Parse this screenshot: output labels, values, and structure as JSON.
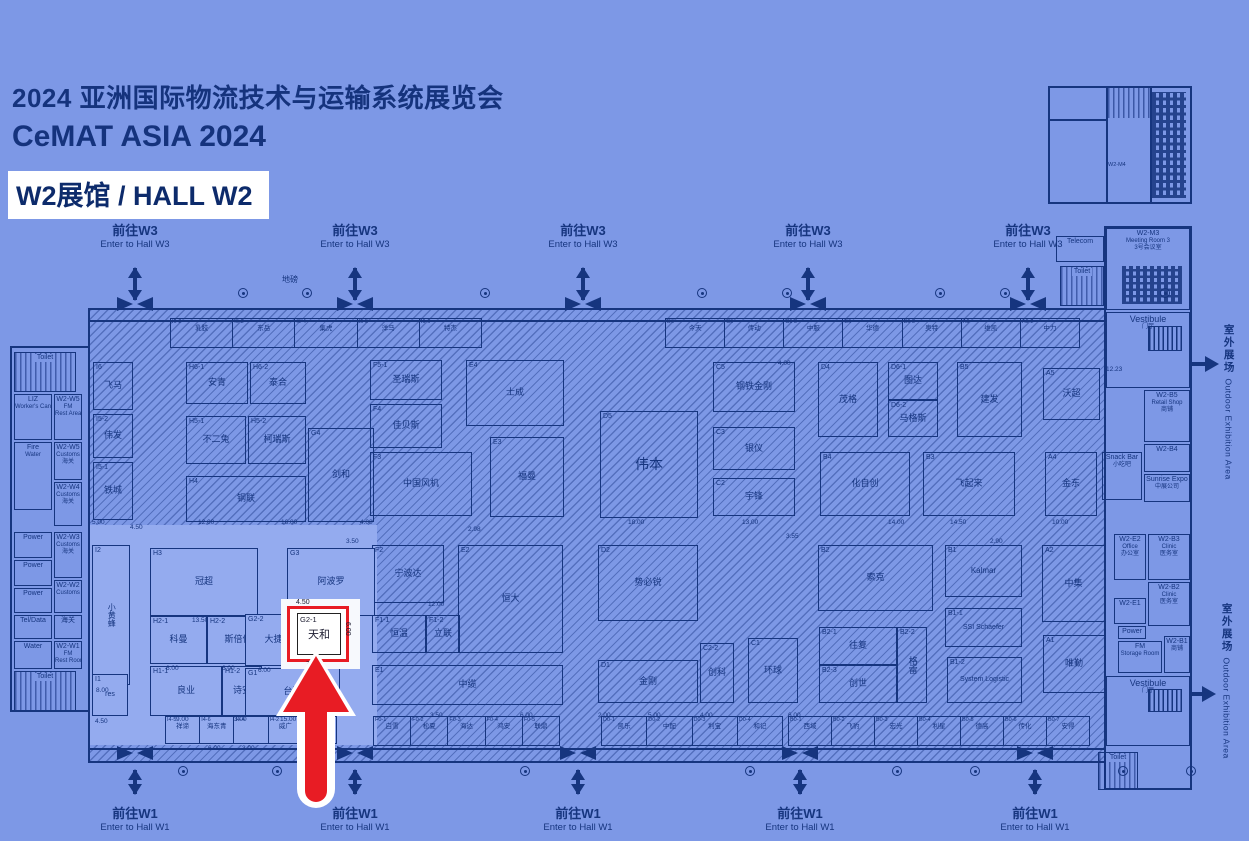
{
  "header": {
    "title_line1": "2024 亚洲国际物流技术与运输系统展览会",
    "title_line2": "CeMAT ASIA 2024",
    "hall_badge": "W2展馆 / HALL W2"
  },
  "nav": {
    "to_w3_cn": "前往W3",
    "to_w3_en": "Enter to Hall W3",
    "to_w1_cn": "前往W1",
    "to_w1_en": "Enter to Hall W1",
    "top_positions": [
      135,
      355,
      583,
      808,
      1028
    ],
    "bottom_positions": [
      135,
      355,
      578,
      800,
      1035
    ]
  },
  "outdoor": {
    "cn": "室外展场",
    "en": "Outdoor Exhibition Area"
  },
  "labels": {
    "weighbridge": "地磅",
    "mini_building": "W2-M4"
  },
  "highlight": {
    "id": "G2-1",
    "name": "天和",
    "dim_top": "4.50",
    "dim_bottom": "7.00",
    "dim_right": "6.00"
  },
  "colors": {
    "background": "#7d98e6",
    "line_navy": "#16357f",
    "light_zone": "#94abef",
    "highlight_red": "#e81c24",
    "badge_bg": "#ffffff"
  },
  "left_wing": {
    "rooms": [
      {
        "x": 14,
        "y": 352,
        "w": 62,
        "h": 40,
        "lines": [
          "Toilet"
        ],
        "hatch": 1
      },
      {
        "x": 14,
        "y": 394,
        "w": 38,
        "h": 46,
        "lines": [
          "LIZ",
          "Worker's Canteen"
        ]
      },
      {
        "x": 54,
        "y": 394,
        "w": 28,
        "h": 46,
        "lines": [
          "W2-W5",
          "FM",
          "Rest Area"
        ]
      },
      {
        "x": 14,
        "y": 442,
        "w": 38,
        "h": 68,
        "lines": [
          "Fire",
          "Water"
        ]
      },
      {
        "x": 54,
        "y": 442,
        "w": 28,
        "h": 38,
        "lines": [
          "W2-W5",
          "Customs",
          "海关"
        ]
      },
      {
        "x": 54,
        "y": 482,
        "w": 28,
        "h": 44,
        "lines": [
          "W2-W4",
          "Customs",
          "海关"
        ]
      },
      {
        "x": 14,
        "y": 532,
        "w": 38,
        "h": 26,
        "lines": [
          "Power"
        ]
      },
      {
        "x": 54,
        "y": 532,
        "w": 28,
        "h": 46,
        "lines": [
          "W2-W3",
          "Customs",
          "海关"
        ]
      },
      {
        "x": 14,
        "y": 560,
        "w": 38,
        "h": 26,
        "lines": [
          "Power"
        ]
      },
      {
        "x": 14,
        "y": 588,
        "w": 38,
        "h": 25,
        "lines": [
          "Power"
        ]
      },
      {
        "x": 54,
        "y": 580,
        "w": 28,
        "h": 33,
        "lines": [
          "W2-W2",
          "Customs"
        ]
      },
      {
        "x": 14,
        "y": 615,
        "w": 38,
        "h": 24,
        "lines": [
          "Tel/Data"
        ]
      },
      {
        "x": 54,
        "y": 615,
        "w": 28,
        "h": 24,
        "lines": [
          "海关"
        ]
      },
      {
        "x": 14,
        "y": 641,
        "w": 38,
        "h": 28,
        "lines": [
          "Water"
        ]
      },
      {
        "x": 54,
        "y": 641,
        "w": 28,
        "h": 28,
        "lines": [
          "W2-W1",
          "FM",
          "Rest Room"
        ]
      },
      {
        "x": 14,
        "y": 671,
        "w": 62,
        "h": 40,
        "lines": [
          "Toilet"
        ],
        "hatch": 1
      }
    ]
  },
  "right_wing": {
    "rooms": [
      {
        "x": 1056,
        "y": 236,
        "w": 48,
        "h": 26,
        "lines": [
          "Telecom"
        ]
      },
      {
        "x": 1060,
        "y": 266,
        "w": 44,
        "h": 40,
        "lines": [
          "Toilet"
        ],
        "hatch": 1
      },
      {
        "x": 1106,
        "y": 228,
        "w": 84,
        "h": 82,
        "lines": [
          "W2-M3",
          "Meeting Room 3",
          "3号会议室"
        ],
        "seats": 1
      },
      {
        "x": 1106,
        "y": 312,
        "w": 84,
        "h": 76,
        "lines": [
          "Vestibule",
          "门厅"
        ],
        "stairs": 1,
        "big": 1
      },
      {
        "x": 1144,
        "y": 390,
        "w": 46,
        "h": 52,
        "lines": [
          "W2-B5",
          "Retail Shop",
          "商铺"
        ]
      },
      {
        "x": 1144,
        "y": 444,
        "w": 46,
        "h": 28,
        "lines": [
          "W2-B4"
        ]
      },
      {
        "x": 1102,
        "y": 452,
        "w": 40,
        "h": 48,
        "lines": [
          "Snack Bar",
          "小吃吧"
        ]
      },
      {
        "x": 1144,
        "y": 474,
        "w": 46,
        "h": 28,
        "lines": [
          "Sunrise Expo",
          "中展公司"
        ]
      },
      {
        "x": 1114,
        "y": 534,
        "w": 32,
        "h": 46,
        "lines": [
          "W2-E2",
          "Office",
          "办公室"
        ]
      },
      {
        "x": 1148,
        "y": 534,
        "w": 42,
        "h": 46,
        "lines": [
          "W2-B3",
          "Clinic",
          "医务室"
        ]
      },
      {
        "x": 1148,
        "y": 582,
        "w": 42,
        "h": 44,
        "lines": [
          "W2-B2",
          "Clinic",
          "医务室"
        ]
      },
      {
        "x": 1114,
        "y": 598,
        "w": 32,
        "h": 26,
        "lines": [
          "W2-E1"
        ]
      },
      {
        "x": 1118,
        "y": 626,
        "w": 28,
        "h": 13,
        "lines": [
          "Power"
        ]
      },
      {
        "x": 1118,
        "y": 641,
        "w": 44,
        "h": 32,
        "lines": [
          "FM",
          "Storage Room"
        ]
      },
      {
        "x": 1164,
        "y": 636,
        "w": 26,
        "h": 37,
        "lines": [
          "W2-B1",
          "商铺"
        ]
      },
      {
        "x": 1106,
        "y": 676,
        "w": 84,
        "h": 70,
        "lines": [
          "Vestibule",
          "门厅"
        ],
        "stairs": 1,
        "big": 1
      },
      {
        "x": 1098,
        "y": 752,
        "w": 40,
        "h": 38,
        "lines": [
          "Toilet"
        ],
        "hatch": 1
      }
    ]
  },
  "booths": [
    {
      "id": "I6",
      "name": "飞马",
      "x": 93,
      "y": 362,
      "w": 40,
      "h": 48
    },
    {
      "id": "I5-2",
      "name": "伟发",
      "x": 93,
      "y": 414,
      "w": 40,
      "h": 44
    },
    {
      "id": "I5-1",
      "name": "铁城",
      "x": 93,
      "y": 462,
      "w": 40,
      "h": 58
    },
    {
      "id": "H6-1",
      "name": "安青",
      "x": 186,
      "y": 362,
      "w": 62,
      "h": 42
    },
    {
      "id": "H6-2",
      "name": "泰合",
      "x": 250,
      "y": 362,
      "w": 56,
      "h": 42
    },
    {
      "id": "H5-1",
      "name": "不二兔",
      "x": 186,
      "y": 416,
      "w": 60,
      "h": 48
    },
    {
      "id": "H5-2",
      "name": "柯瑞斯",
      "x": 248,
      "y": 416,
      "w": 58,
      "h": 48
    },
    {
      "id": "H4",
      "name": "钢联",
      "x": 186,
      "y": 476,
      "w": 120,
      "h": 46
    },
    {
      "id": "G4",
      "name": "剑和",
      "x": 308,
      "y": 428,
      "w": 66,
      "h": 94
    },
    {
      "id": "F5-1",
      "name": "圣瑞斯",
      "x": 370,
      "y": 360,
      "w": 72,
      "h": 40
    },
    {
      "id": "F4",
      "name": "佳贝斯",
      "x": 370,
      "y": 404,
      "w": 72,
      "h": 44
    },
    {
      "id": "F3",
      "name": "中国风机",
      "x": 370,
      "y": 452,
      "w": 102,
      "h": 64
    },
    {
      "id": "E4",
      "name": "士成",
      "x": 466,
      "y": 360,
      "w": 98,
      "h": 66
    },
    {
      "id": "E3",
      "name": "福曼",
      "x": 490,
      "y": 437,
      "w": 74,
      "h": 80
    },
    {
      "id": "D5",
      "name": "伟本",
      "x": 600,
      "y": 411,
      "w": 98,
      "h": 107,
      "fs": 14
    },
    {
      "id": "C5",
      "name": "钢铁金刚",
      "x": 713,
      "y": 362,
      "w": 82,
      "h": 50
    },
    {
      "id": "D4",
      "name": "茂格",
      "x": 818,
      "y": 362,
      "w": 60,
      "h": 75
    },
    {
      "id": "D6-1",
      "name": "图达",
      "x": 888,
      "y": 362,
      "w": 50,
      "h": 38
    },
    {
      "id": "D6-2",
      "name": "马格斯",
      "x": 888,
      "y": 400,
      "w": 50,
      "h": 37
    },
    {
      "id": "B5",
      "name": "建发",
      "x": 957,
      "y": 362,
      "w": 65,
      "h": 75
    },
    {
      "id": "A5",
      "name": "沃超",
      "x": 1043,
      "y": 368,
      "w": 57,
      "h": 52
    },
    {
      "id": "C3",
      "name": "银仪",
      "x": 713,
      "y": 427,
      "w": 82,
      "h": 43
    },
    {
      "id": "C2",
      "name": "宇锋",
      "x": 713,
      "y": 478,
      "w": 82,
      "h": 38
    },
    {
      "id": "B4",
      "name": "化自创",
      "x": 820,
      "y": 452,
      "w": 90,
      "h": 64
    },
    {
      "id": "B3",
      "name": "飞起来",
      "x": 923,
      "y": 452,
      "w": 92,
      "h": 64
    },
    {
      "id": "A4",
      "name": "金东",
      "x": 1045,
      "y": 452,
      "w": 52,
      "h": 64
    },
    {
      "id": "F2",
      "name": "宁波达",
      "x": 372,
      "y": 545,
      "w": 72,
      "h": 58
    },
    {
      "id": "F1-1",
      "name": "恒温",
      "x": 372,
      "y": 615,
      "w": 54,
      "h": 38
    },
    {
      "id": "F1-2",
      "name": "立联",
      "x": 426,
      "y": 615,
      "w": 34,
      "h": 38
    },
    {
      "id": "E2",
      "name": "恒大",
      "x": 458,
      "y": 545,
      "w": 105,
      "h": 108
    },
    {
      "id": "E1",
      "name": "中缆",
      "x": 372,
      "y": 665,
      "w": 191,
      "h": 40
    },
    {
      "id": "D2",
      "name": "势必锐",
      "x": 598,
      "y": 545,
      "w": 100,
      "h": 76
    },
    {
      "id": "D1",
      "name": "金刚",
      "x": 598,
      "y": 660,
      "w": 100,
      "h": 43
    },
    {
      "id": "C1",
      "name": "环球",
      "x": 748,
      "y": 638,
      "w": 50,
      "h": 65
    },
    {
      "id": "C2-2",
      "name": "创科",
      "x": 700,
      "y": 643,
      "w": 34,
      "h": 60
    },
    {
      "id": "B2",
      "name": "索克",
      "x": 818,
      "y": 545,
      "w": 115,
      "h": 66
    },
    {
      "id": "B2-1",
      "name": "往复",
      "x": 819,
      "y": 627,
      "w": 78,
      "h": 38
    },
    {
      "id": "B2-3",
      "name": "创世",
      "x": 819,
      "y": 665,
      "w": 78,
      "h": 38
    },
    {
      "id": "B2-2",
      "name": "格雷",
      "x": 897,
      "y": 627,
      "w": 30,
      "h": 76,
      "v": 1
    },
    {
      "id": "B1",
      "name": "Kalmar",
      "x": 945,
      "y": 545,
      "w": 77,
      "h": 52,
      "fs": 8
    },
    {
      "id": "B1-1",
      "name": "SSI Schaefer",
      "x": 945,
      "y": 608,
      "w": 77,
      "h": 39,
      "fs": 7
    },
    {
      "id": "B1-2",
      "name": "System Logistic",
      "x": 947,
      "y": 657,
      "w": 75,
      "h": 46,
      "fs": 7
    },
    {
      "id": "A2",
      "name": "中集",
      "x": 1042,
      "y": 545,
      "w": 63,
      "h": 77
    },
    {
      "id": "A1",
      "name": "唯勤",
      "x": 1043,
      "y": 635,
      "w": 62,
      "h": 58
    },
    {
      "id": "I2",
      "name": "小黄蜂",
      "x": 92,
      "y": 545,
      "w": 38,
      "h": 140,
      "v": 1,
      "lt": 1,
      "fs": 8
    },
    {
      "id": "H3",
      "name": "冠超",
      "x": 150,
      "y": 548,
      "w": 108,
      "h": 68,
      "lt": 1
    },
    {
      "id": "G3",
      "name": "阿波罗",
      "x": 287,
      "y": 548,
      "w": 88,
      "h": 68,
      "lt": 1
    },
    {
      "id": "H2-1",
      "name": "科曼",
      "x": 150,
      "y": 616,
      "w": 57,
      "h": 48,
      "lt": 1
    },
    {
      "id": "H2-2",
      "name": "斯倍优",
      "x": 207,
      "y": 616,
      "w": 62,
      "h": 48,
      "lt": 1
    },
    {
      "id": "G2-2",
      "name": "大捷",
      "x": 245,
      "y": 614,
      "w": 57,
      "h": 52,
      "lt": 1
    },
    {
      "id": "H1-1",
      "name": "良业",
      "x": 150,
      "y": 666,
      "w": 72,
      "h": 50,
      "lt": 1
    },
    {
      "id": "H1-2",
      "name": "诗安",
      "x": 222,
      "y": 666,
      "w": 40,
      "h": 50,
      "lt": 1
    },
    {
      "id": "G1",
      "name": "台翔",
      "x": 245,
      "y": 668,
      "w": 95,
      "h": 48,
      "lt": 1
    },
    {
      "id": "I1",
      "name": "res",
      "x": 92,
      "y": 674,
      "w": 36,
      "h": 42,
      "lt": 1,
      "fs": 7
    }
  ],
  "strips": [
    {
      "x": 170,
      "y": 318,
      "w": 312,
      "h": 30,
      "cells": [
        {
          "id": "I6-2",
          "name": "乳胶"
        },
        {
          "id": "I6-3",
          "name": "东岳"
        },
        {
          "id": "I6-4",
          "name": "集虎"
        },
        {
          "id": "I6-5",
          "name": "洋马"
        },
        {
          "id": "I6-6",
          "name": "特杰"
        }
      ]
    },
    {
      "x": 665,
      "y": 318,
      "w": 415,
      "h": 30,
      "cells": [
        {
          "id": "D6",
          "name": "今天"
        },
        {
          "id": "C6",
          "name": "传动"
        },
        {
          "id": "C6-2",
          "name": "中服"
        },
        {
          "id": "B6",
          "name": "华德"
        },
        {
          "id": "B6-2",
          "name": "奥特"
        },
        {
          "id": "A6",
          "name": "维凯"
        },
        {
          "id": "A6-2",
          "name": "中力"
        }
      ]
    },
    {
      "x": 373,
      "y": 716,
      "w": 187,
      "h": 30,
      "cells": [
        {
          "id": "F0-1",
          "name": "白雪"
        },
        {
          "id": "F0-2",
          "name": "松夏"
        },
        {
          "id": "F0-3",
          "name": "海达"
        },
        {
          "id": "F0-4",
          "name": "鸿安"
        },
        {
          "id": "F0-5",
          "name": "联鼎"
        }
      ]
    },
    {
      "x": 601,
      "y": 716,
      "w": 182,
      "h": 30,
      "cells": [
        {
          "id": "D0-1",
          "name": "凯乐"
        },
        {
          "id": "D0-2",
          "name": "中配"
        },
        {
          "id": "D0-3",
          "name": "利宝"
        },
        {
          "id": "D0-4",
          "name": "和记"
        }
      ]
    },
    {
      "x": 788,
      "y": 716,
      "w": 302,
      "h": 30,
      "cells": [
        {
          "id": "B0-1",
          "name": "西域"
        },
        {
          "id": "B0-2",
          "name": "飞豹"
        },
        {
          "id": "B0-3",
          "name": "宏光"
        },
        {
          "id": "B0-4",
          "name": "利星"
        },
        {
          "id": "B0-5",
          "name": "德高"
        },
        {
          "id": "B0-6",
          "name": "传化"
        },
        {
          "id": "B0-7",
          "name": "安得"
        }
      ]
    },
    {
      "x": 165,
      "y": 716,
      "w": 172,
      "h": 28,
      "lt": 1,
      "cells": [
        {
          "id": "I4-5",
          "name": "祥谛"
        },
        {
          "id": "I4-6",
          "name": "海东青"
        },
        {
          "id": "I4-4",
          "name": ""
        },
        {
          "id": "I4-2",
          "name": "威广"
        },
        {
          "id": "I4-1",
          "name": "易卡"
        }
      ]
    }
  ],
  "dims": [
    {
      "t": "5.00",
      "x": 92,
      "y": 519
    },
    {
      "t": "4.50",
      "x": 130,
      "y": 524
    },
    {
      "t": "12.00",
      "x": 198,
      "y": 519
    },
    {
      "t": "16.00",
      "x": 281,
      "y": 519
    },
    {
      "t": "4.00",
      "x": 360,
      "y": 519
    },
    {
      "t": "18.00",
      "x": 628,
      "y": 519
    },
    {
      "t": "13.00",
      "x": 742,
      "y": 519
    },
    {
      "t": "14.00",
      "x": 888,
      "y": 519
    },
    {
      "t": "14.50",
      "x": 950,
      "y": 519
    },
    {
      "t": "10.00",
      "x": 1052,
      "y": 519
    },
    {
      "t": "8.00",
      "x": 96,
      "y": 687
    },
    {
      "t": "13.50",
      "x": 192,
      "y": 617
    },
    {
      "t": "3.50",
      "x": 346,
      "y": 538
    },
    {
      "t": "4.50",
      "x": 318,
      "y": 601
    },
    {
      "t": "6.00",
      "x": 166,
      "y": 665
    },
    {
      "t": "6.00",
      "x": 222,
      "y": 665
    },
    {
      "t": "6.00",
      "x": 258,
      "y": 667
    },
    {
      "t": "9.00",
      "x": 176,
      "y": 716
    },
    {
      "t": "3.00",
      "x": 234,
      "y": 716
    },
    {
      "t": "15.00",
      "x": 280,
      "y": 716
    },
    {
      "t": "4.50",
      "x": 95,
      "y": 718
    },
    {
      "t": "6.00",
      "x": 208,
      "y": 745
    },
    {
      "t": "3.00",
      "x": 242,
      "y": 745
    },
    {
      "t": "12.00",
      "x": 428,
      "y": 601
    },
    {
      "t": "2.98",
      "x": 468,
      "y": 526
    },
    {
      "t": "3.55",
      "x": 786,
      "y": 533
    },
    {
      "t": "2.90",
      "x": 990,
      "y": 538
    },
    {
      "t": "12.23",
      "x": 1106,
      "y": 366
    },
    {
      "t": "4.00",
      "x": 778,
      "y": 360
    },
    {
      "t": "3.50",
      "x": 430,
      "y": 712
    },
    {
      "t": "6.00",
      "x": 520,
      "y": 712
    },
    {
      "t": "2.00",
      "x": 598,
      "y": 712
    },
    {
      "t": "5.00",
      "x": 648,
      "y": 712
    },
    {
      "t": "4.00",
      "x": 700,
      "y": 712
    },
    {
      "t": "6.00",
      "x": 788,
      "y": 712
    }
  ],
  "doors_top": [
    238,
    302,
    480,
    697,
    782,
    935,
    1000,
    1160
  ],
  "doors_bottom": [
    178,
    272,
    520,
    745,
    892,
    970,
    1118,
    1186
  ]
}
